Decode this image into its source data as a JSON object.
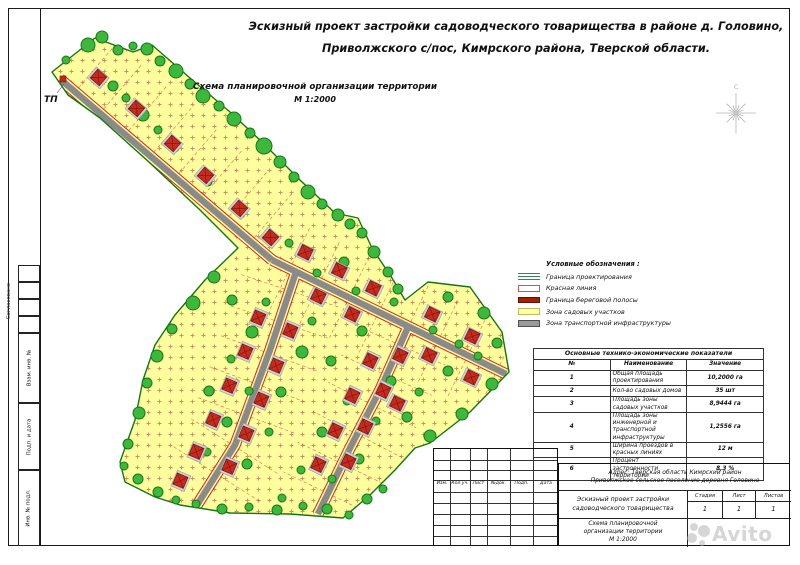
{
  "title": {
    "line1": "Эскизный проект застройки садоводческого товарищества в районе д. Головино,",
    "line2": "Приволжского с/пос, Кимрского района, Тверской области."
  },
  "subtitle": {
    "line1": "Схема планировочной организации территории",
    "scale": "М 1:2000"
  },
  "legend": {
    "title": "Условные обозначения :",
    "items": [
      {
        "label": "Граница проектирования",
        "type": "green-lines"
      },
      {
        "label": "Красная линия",
        "type": "red-line"
      },
      {
        "label": "Граница береговой полосы",
        "type": "dark-red-bar"
      },
      {
        "label": "Зона садовых участков",
        "type": "yellow-fill"
      },
      {
        "label": "Зона транспортной инфраструктуры",
        "type": "gray-fill"
      }
    ]
  },
  "table": {
    "title": "Основные технико-экономические показатели",
    "headers": [
      "№",
      "Наименование",
      "Значение"
    ],
    "rows": [
      [
        "1",
        "Общая площадь проектирования",
        "10,2000 га"
      ],
      [
        "2",
        "Кол-во садовых домов",
        "35 шт"
      ],
      [
        "3",
        "Площадь зоны садовых участков",
        "8,9444 га"
      ],
      [
        "4",
        "Площадь зоны инженерной и транспортной инфраструктуры",
        "1,2556 га"
      ],
      [
        "5",
        "Ширина проездов в красных линиях",
        "12 м"
      ],
      [
        "6",
        "Процент застроенности территории",
        "8,3 %"
      ]
    ]
  },
  "stamp": {
    "header_cells": [
      "Изм.",
      "Кол.уч.",
      "Лист",
      "№док.",
      "Подп.",
      "Дата"
    ],
    "address_lines": [
      "Адрес: Тверская область Кимрский район",
      "Приволжское сельское поселение деревня Головино"
    ],
    "project_lines": [
      "Эскизный проект застройки",
      "садоводческого товарищества"
    ],
    "stage_headers": [
      "Стадия",
      "Лист",
      "Листов"
    ],
    "stage_values": [
      "1",
      "1",
      "1"
    ],
    "sheet_lines": [
      "Схема планировочной",
      "организации территории",
      "М 1:2000"
    ]
  },
  "side": {
    "approve": "Согласовано",
    "empty_ys": [
      265,
      282,
      299,
      316
    ],
    "boxes": [
      {
        "label": "Взам. инв. №",
        "y": 333,
        "h": 70
      },
      {
        "label": "Подп. и дата",
        "y": 403,
        "h": 67
      },
      {
        "label": "Инв. № подл.",
        "y": 470,
        "h": 76
      }
    ]
  },
  "watermark": {
    "text": "Avito"
  },
  "colors": {
    "zone_yellow": "#FFFF9E",
    "dot": "#D98A5F",
    "road_gray": "#8A8A8A",
    "red_line": "#DD2222",
    "boundary_green": "#117711",
    "tree_fill": "#3CB83C",
    "tree_stroke": "#157815",
    "house_red": "#C62B1E",
    "house_dark": "#7A150C",
    "pad_gray": "#CFCFCF",
    "compass_gray": "#B5B5B5",
    "tp_red": "#CC2211"
  },
  "map": {
    "tp_label": "ТП",
    "north_letter": "С",
    "outline": [
      [
        52,
        72
      ],
      [
        95,
        38
      ],
      [
        133,
        52
      ],
      [
        152,
        45
      ],
      [
        190,
        78
      ],
      [
        230,
        112
      ],
      [
        262,
        142
      ],
      [
        300,
        180
      ],
      [
        335,
        213
      ],
      [
        358,
        218
      ],
      [
        372,
        248
      ],
      [
        392,
        278
      ],
      [
        405,
        300
      ],
      [
        428,
        282
      ],
      [
        470,
        287
      ],
      [
        502,
        332
      ],
      [
        509,
        372
      ],
      [
        470,
        412
      ],
      [
        430,
        443
      ],
      [
        415,
        448
      ],
      [
        395,
        470
      ],
      [
        370,
        495
      ],
      [
        343,
        518
      ],
      [
        290,
        514
      ],
      [
        230,
        513
      ],
      [
        180,
        505
      ],
      [
        155,
        497
      ],
      [
        125,
        482
      ],
      [
        120,
        462
      ],
      [
        135,
        420
      ],
      [
        143,
        380
      ],
      [
        155,
        345
      ],
      [
        175,
        315
      ],
      [
        205,
        280
      ],
      [
        238,
        248
      ],
      [
        200,
        210
      ],
      [
        150,
        163
      ],
      [
        100,
        118
      ],
      [
        68,
        95
      ]
    ],
    "roads": [
      {
        "pts": [
          [
            60,
            79
          ],
          [
            272,
            260
          ]
        ],
        "plots": [
          "left"
        ],
        "plen": 58
      },
      {
        "pts": [
          [
            272,
            260
          ],
          [
            506,
            374
          ]
        ],
        "plots": [
          "left",
          "right"
        ],
        "plen": 40
      },
      {
        "pts": [
          [
            296,
            272
          ],
          [
            270,
            350
          ],
          [
            235,
            445
          ],
          [
            197,
            505
          ]
        ],
        "plots": [
          "left",
          "right"
        ],
        "plen": 46
      },
      {
        "pts": [
          [
            408,
            327
          ],
          [
            380,
            390
          ],
          [
            350,
            448
          ],
          [
            318,
            514
          ]
        ],
        "plots": [
          "left",
          "right"
        ],
        "plen": 44
      }
    ],
    "houses": [
      [
        98,
        78,
        41
      ],
      [
        136,
        109,
        41
      ],
      [
        172,
        144,
        41
      ],
      [
        205,
        176,
        41
      ],
      [
        239,
        209,
        41
      ],
      [
        270,
        238,
        41
      ],
      [
        305,
        253,
        26
      ],
      [
        339,
        271,
        26
      ],
      [
        373,
        289,
        26
      ],
      [
        318,
        297,
        26
      ],
      [
        352,
        315,
        26
      ],
      [
        432,
        315,
        26
      ],
      [
        472,
        337,
        26
      ],
      [
        429,
        356,
        26
      ],
      [
        471,
        378,
        26
      ],
      [
        397,
        404,
        26
      ],
      [
        259,
        318,
        -67
      ],
      [
        246,
        352,
        -67
      ],
      [
        230,
        386,
        -67
      ],
      [
        214,
        420,
        -67
      ],
      [
        197,
        452,
        -67
      ],
      [
        181,
        481,
        -67
      ],
      [
        291,
        331,
        -67
      ],
      [
        277,
        366,
        -67
      ],
      [
        262,
        400,
        -67
      ],
      [
        247,
        434,
        -67
      ],
      [
        230,
        467,
        -67
      ],
      [
        371,
        361,
        -64
      ],
      [
        353,
        396,
        -64
      ],
      [
        336,
        431,
        -64
      ],
      [
        319,
        465,
        -64
      ],
      [
        401,
        356,
        -64
      ],
      [
        384,
        391,
        -64
      ],
      [
        366,
        427,
        -64
      ],
      [
        349,
        462,
        -64
      ]
    ],
    "trees": [
      [
        88,
        45,
        7
      ],
      [
        102,
        37,
        6
      ],
      [
        118,
        50,
        5
      ],
      [
        133,
        46,
        4
      ],
      [
        147,
        49,
        6
      ],
      [
        160,
        61,
        5
      ],
      [
        176,
        71,
        7
      ],
      [
        190,
        84,
        5
      ],
      [
        203,
        96,
        7
      ],
      [
        219,
        106,
        5
      ],
      [
        234,
        119,
        7
      ],
      [
        250,
        133,
        5
      ],
      [
        264,
        146,
        8
      ],
      [
        280,
        162,
        6
      ],
      [
        294,
        177,
        5
      ],
      [
        308,
        192,
        7
      ],
      [
        322,
        204,
        5
      ],
      [
        338,
        215,
        6
      ],
      [
        350,
        224,
        5
      ],
      [
        113,
        86,
        5
      ],
      [
        143,
        115,
        6
      ],
      [
        175,
        148,
        4
      ],
      [
        208,
        182,
        4
      ],
      [
        241,
        214,
        4
      ],
      [
        126,
        98,
        4
      ],
      [
        158,
        130,
        4
      ],
      [
        362,
        233,
        5
      ],
      [
        374,
        252,
        6
      ],
      [
        388,
        272,
        5
      ],
      [
        398,
        289,
        5
      ],
      [
        448,
        297,
        5
      ],
      [
        484,
        313,
        6
      ],
      [
        497,
        343,
        5
      ],
      [
        492,
        384,
        6
      ],
      [
        462,
        414,
        6
      ],
      [
        430,
        436,
        6
      ],
      [
        407,
        417,
        5
      ],
      [
        419,
        392,
        4
      ],
      [
        448,
        371,
        5
      ],
      [
        459,
        344,
        4
      ],
      [
        433,
        330,
        4
      ],
      [
        478,
        356,
        4
      ],
      [
        214,
        277,
        6
      ],
      [
        193,
        303,
        7
      ],
      [
        172,
        329,
        5
      ],
      [
        157,
        356,
        6
      ],
      [
        147,
        383,
        5
      ],
      [
        139,
        413,
        6
      ],
      [
        128,
        444,
        5
      ],
      [
        124,
        466,
        4
      ],
      [
        138,
        479,
        5
      ],
      [
        158,
        492,
        5
      ],
      [
        176,
        500,
        4
      ],
      [
        196,
        504,
        4
      ],
      [
        222,
        509,
        5
      ],
      [
        249,
        507,
        4
      ],
      [
        277,
        510,
        5
      ],
      [
        303,
        506,
        4
      ],
      [
        327,
        509,
        5
      ],
      [
        349,
        515,
        4
      ],
      [
        367,
        499,
        5
      ],
      [
        383,
        489,
        4
      ],
      [
        232,
        300,
        5
      ],
      [
        252,
        332,
        6
      ],
      [
        231,
        359,
        4
      ],
      [
        209,
        391,
        5
      ],
      [
        249,
        391,
        4
      ],
      [
        227,
        422,
        5
      ],
      [
        207,
        452,
        4
      ],
      [
        247,
        464,
        5
      ],
      [
        269,
        432,
        4
      ],
      [
        281,
        392,
        5
      ],
      [
        302,
        352,
        6
      ],
      [
        266,
        302,
        4
      ],
      [
        312,
        321,
        4
      ],
      [
        331,
        361,
        5
      ],
      [
        347,
        401,
        4
      ],
      [
        322,
        432,
        5
      ],
      [
        301,
        470,
        4
      ],
      [
        282,
        498,
        4
      ],
      [
        332,
        479,
        4
      ],
      [
        359,
        459,
        5
      ],
      [
        376,
        421,
        4
      ],
      [
        391,
        381,
        5
      ],
      [
        399,
        352,
        4
      ],
      [
        362,
        331,
        5
      ],
      [
        394,
        302,
        4
      ],
      [
        356,
        291,
        4
      ],
      [
        344,
        262,
        5
      ],
      [
        317,
        273,
        4
      ],
      [
        289,
        243,
        4
      ],
      [
        66,
        60,
        4
      ]
    ],
    "tp_square": [
      60,
      76,
      6,
      6
    ],
    "compass_center": [
      736,
      113
    ]
  }
}
